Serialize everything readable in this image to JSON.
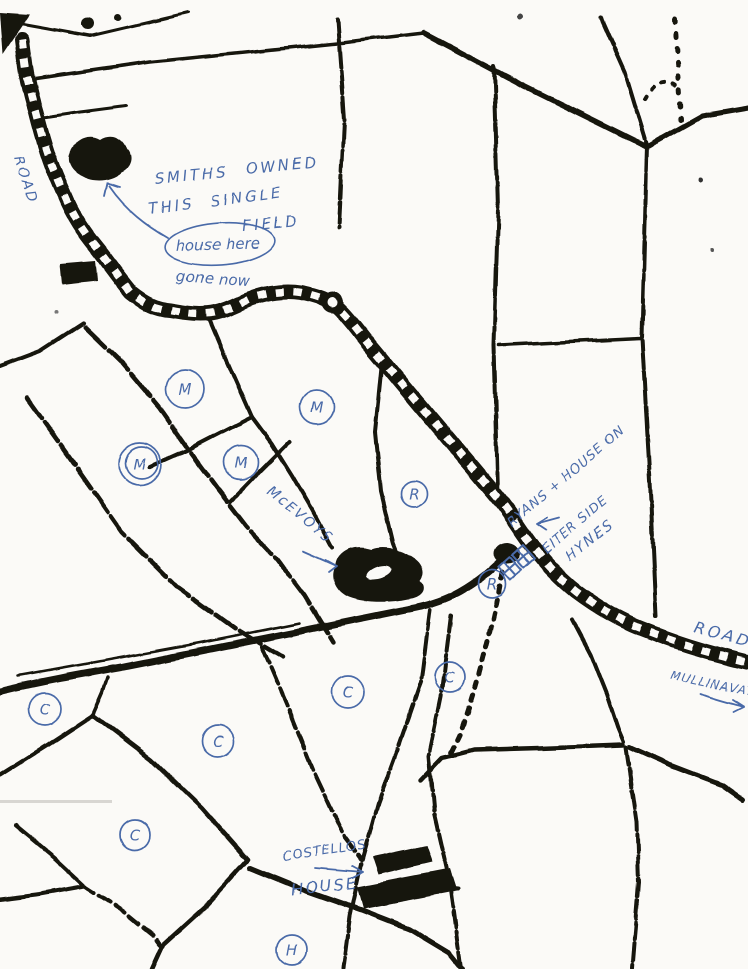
{
  "page": {
    "background": "#fbfaf7",
    "ink_black": "#171411",
    "ink_blue": "#4a6aa8"
  },
  "labels": {
    "road_top_left": "ROAD",
    "smiths_1": "SMITHS OWNED",
    "smiths_2": "THIS SINGLE",
    "smiths_3": "FIELD",
    "house_here": "house here",
    "gone_now": "gone now",
    "mcevoys": "McEVOYS",
    "ryans": "RYANS + HOUSE ON",
    "either_side": "EITER SIDE",
    "hynes": "HYNES",
    "road_right": "ROAD",
    "mullinavat": "MULLINAVAT",
    "costellos": "COSTELLOS",
    "costellos_house": "HOUSE"
  },
  "markers": [
    {
      "letter": "M",
      "x": 185,
      "y": 389,
      "r": 19
    },
    {
      "letter": "M",
      "x": 317,
      "y": 407,
      "r": 17
    },
    {
      "letter": "M",
      "x": 140,
      "y": 464,
      "r": 21,
      "double": true
    },
    {
      "letter": "M",
      "x": 241,
      "y": 462,
      "r": 17
    },
    {
      "letter": "R",
      "x": 414,
      "y": 494,
      "r": 13
    },
    {
      "letter": "R",
      "x": 492,
      "y": 584,
      "r": 14
    },
    {
      "letter": "C",
      "x": 45,
      "y": 709,
      "r": 16
    },
    {
      "letter": "C",
      "x": 218,
      "y": 741,
      "r": 16
    },
    {
      "letter": "C",
      "x": 348,
      "y": 692,
      "r": 16
    },
    {
      "letter": "C",
      "x": 450,
      "y": 677,
      "r": 15
    },
    {
      "letter": "C",
      "x": 135,
      "y": 835,
      "r": 15
    },
    {
      "letter": "H",
      "x": 292,
      "y": 950,
      "r": 15
    }
  ]
}
